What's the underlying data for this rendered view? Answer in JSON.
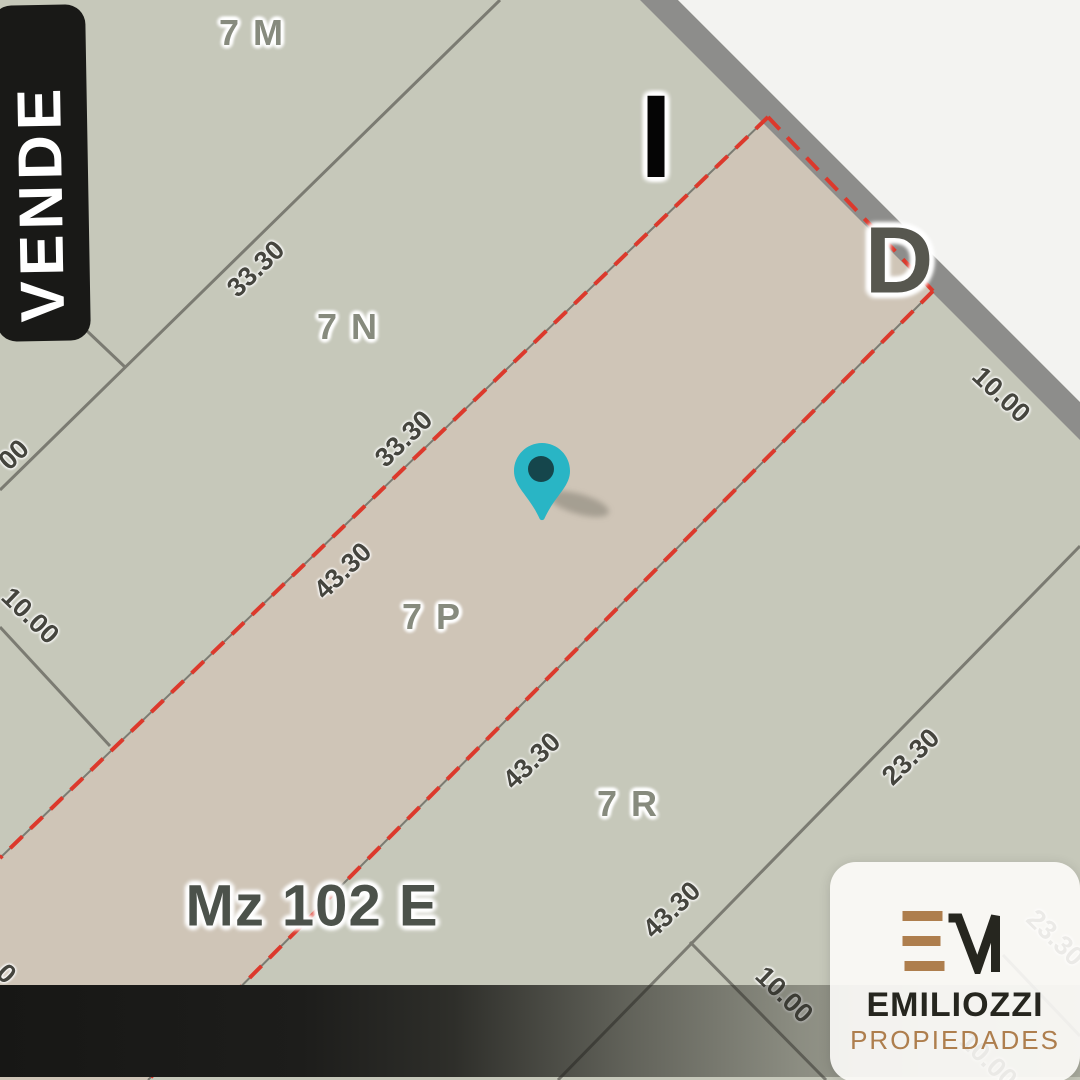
{
  "colors": {
    "map_bg": "#c6c8ba",
    "strip": "#cfc5b7",
    "road_band": "#8d8d8b",
    "outside": "#f3f3f1",
    "boundary_red": "#dc392c",
    "boundary_gray": "#7b7b72",
    "parcel_label": "#878b7e",
    "block_label": "#4c524b",
    "measure": "#45453e",
    "banner_bg": "#191917",
    "banner_text": "#ffffff",
    "pin": "#29b5c5",
    "pin_core": "#15464c",
    "brand_black": "#26261f",
    "brand_bronze": "#ae7e4d",
    "card_bg": "rgba(253,252,250,0.9)"
  },
  "banner": {
    "label": "VENDE"
  },
  "map": {
    "block_label": "Mz 102 E",
    "block_label_pos": {
      "x": 312,
      "y": 906
    },
    "corner_letters": [
      {
        "text": "I",
        "x": 656,
        "y": 137,
        "type": "letter-i",
        "name": "corner-letter-i"
      },
      {
        "text": "D",
        "x": 899,
        "y": 261,
        "type": "letter-d",
        "name": "corner-letter-d"
      }
    ],
    "parcel_labels": [
      {
        "text": "7 M",
        "x": 252,
        "y": 33
      },
      {
        "text": "7 N",
        "x": 348,
        "y": 327
      },
      {
        "text": "7 P",
        "x": 432,
        "y": 617
      },
      {
        "text": "7 R",
        "x": 628,
        "y": 804
      }
    ],
    "measurements": [
      {
        "text": "33.30",
        "x": 256,
        "y": 269,
        "rot": -44
      },
      {
        "text": "33.30",
        "x": 404,
        "y": 439,
        "rot": -44
      },
      {
        "text": "43.30",
        "x": 343,
        "y": 571,
        "rot": -44
      },
      {
        "text": "43.30",
        "x": 532,
        "y": 761,
        "rot": -44
      },
      {
        "text": "43.30",
        "x": 672,
        "y": 910,
        "rot": -44
      },
      {
        "text": "23.30",
        "x": 911,
        "y": 757,
        "rot": -44
      },
      {
        "text": "10.00",
        "x": 1001,
        "y": 395,
        "rot": 43
      },
      {
        "text": "10.00",
        "x": 784,
        "y": 995,
        "rot": 44
      },
      {
        "text": "10.00",
        "x": 30,
        "y": 616,
        "rot": 44
      },
      {
        "text": "00",
        "x": 14,
        "y": 455,
        "rot": -44
      },
      {
        "text": "0",
        "x": 6,
        "y": 974,
        "rot": 44
      },
      {
        "text": "23.30",
        "x": 1055,
        "y": 938,
        "rot": 44
      },
      {
        "text": "10.00",
        "x": 988,
        "y": 1060,
        "rot": 44
      }
    ]
  },
  "logo_card": {
    "brand": "EMILIOZZI",
    "tagline": "PROPIEDADES",
    "monogram_icon": "em-monogram"
  }
}
